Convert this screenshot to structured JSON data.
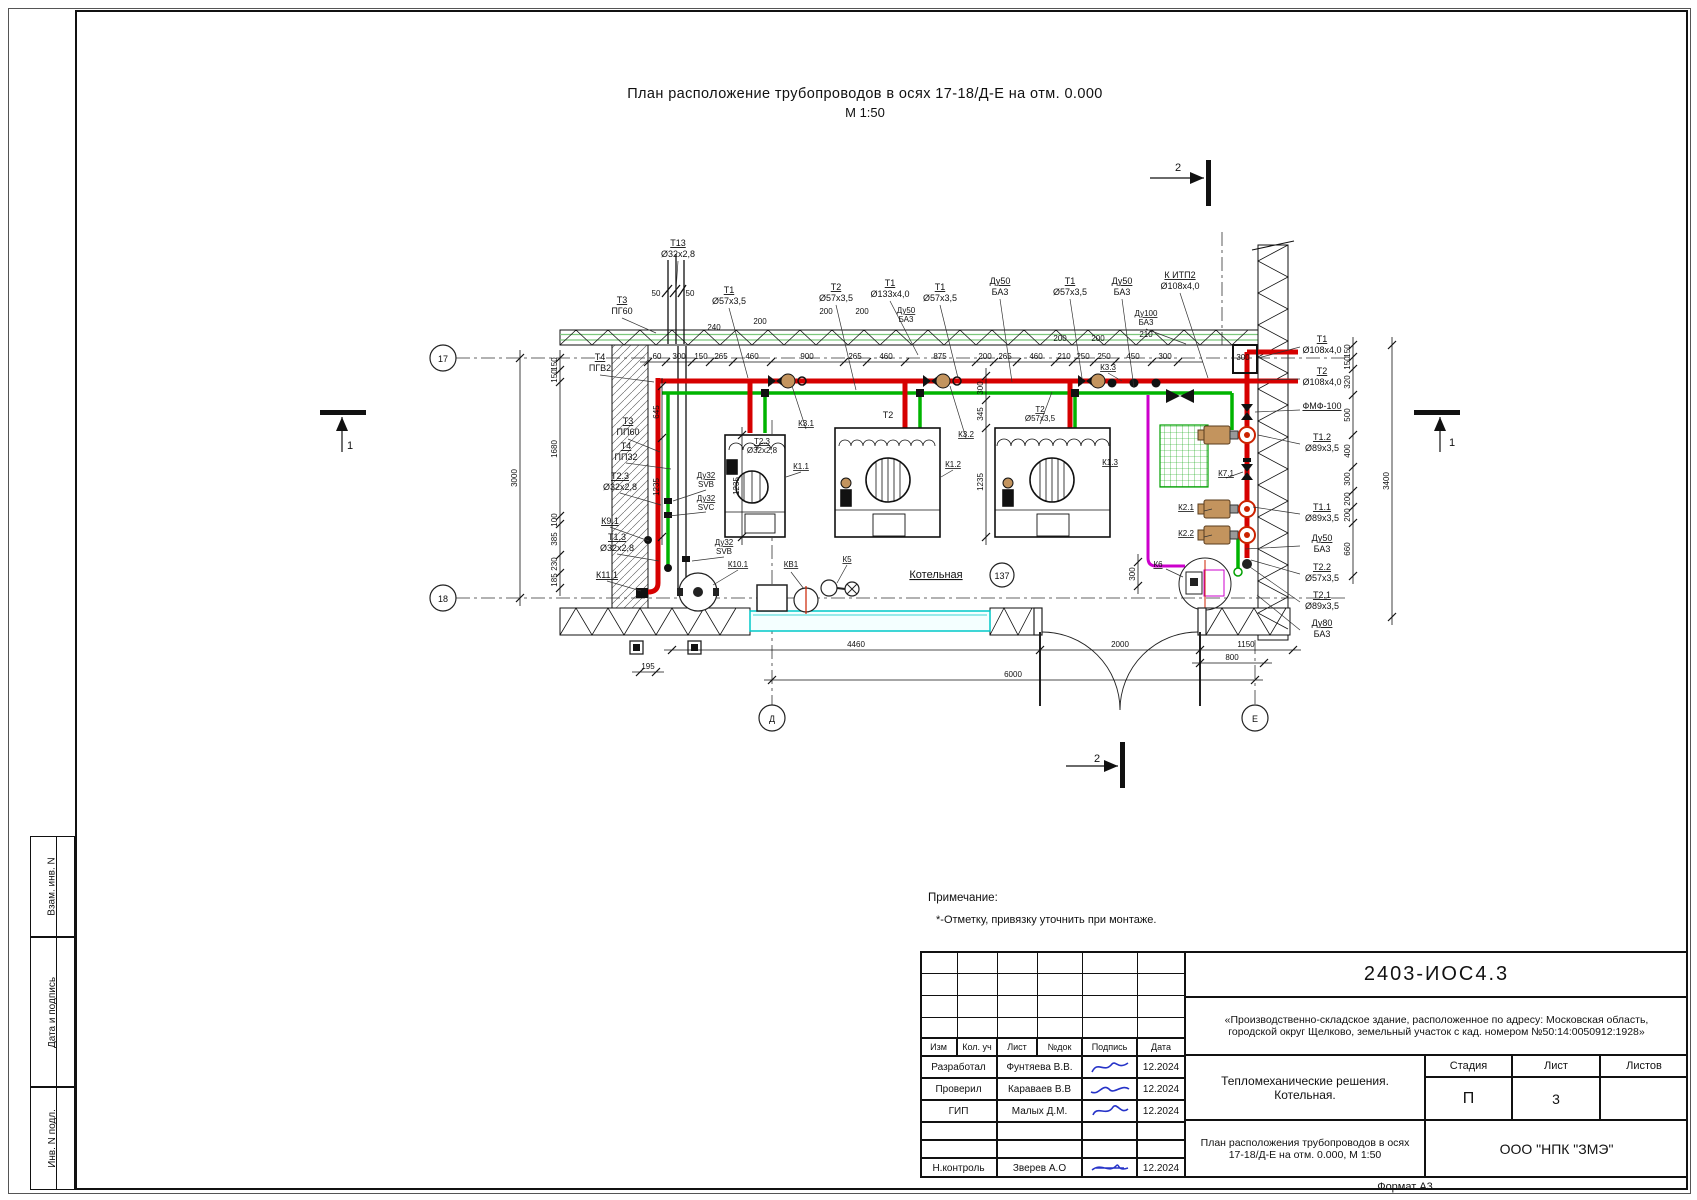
{
  "page": {
    "title_line1": "План расположение трубопроводов в осях 17-18/Д-Е на отм. 0.000",
    "title_line2": "М 1:50",
    "format_label": "Формат А3"
  },
  "sidebar": {
    "cells": [
      "Взам. инв. N",
      "Дата и подпись",
      "Инв. N подл."
    ]
  },
  "notes": {
    "heading": "Примечание:",
    "item1": "*-Отметку, привязку уточнить при монтаже."
  },
  "title_block": {
    "doc_number": "2403-ИОС4.3",
    "project_description": "«Производственно-складское здание, расположенное по адресу: Московская область, городской округ Щелково, земельный участок с кад. номером №50:14:0050912:1928»",
    "rev_headers": [
      "Изм",
      "Кол. уч",
      "Лист",
      "№док",
      "Подпись",
      "Дата"
    ],
    "signature_rows": [
      {
        "role": "Разработал",
        "name": "Фунтяева В.В.",
        "date": "12.2024"
      },
      {
        "role": "Проверил",
        "name": "Караваев В.В",
        "date": "12.2024"
      },
      {
        "role": "ГИП",
        "name": "Малых Д.М.",
        "date": "12.2024"
      },
      {
        "role": "Н.контроль",
        "name": "Зверев А.О",
        "date": "12.2024"
      }
    ],
    "section_title": "Тепломеханические решения. Котельная.",
    "sheet_title": "План расположения трубопроводов в осях 17-18/Д-Е на отм. 0.000, М 1:50",
    "stage_header": "Стадия",
    "sheet_header": "Лист",
    "sheets_header": "Листов",
    "stage_value": "П",
    "sheet_value": "3",
    "sheets_value": "",
    "company": "ООО \"НПК \"ЗМЭ\""
  },
  "plan": {
    "room_label": "Котельная",
    "room_number": "137",
    "colors": {
      "pipe_supply": "#d60000",
      "pipe_return": "#00b400",
      "pipe_aux": "#cc00cc",
      "channel": "#00c8c8",
      "pump_body": "#c3945e",
      "grate": "#00a000",
      "signature": "#2633c8"
    },
    "labels": [
      {
        "x": 678,
        "y": 246,
        "t": "Т13",
        "u": 1
      },
      {
        "x": 678,
        "y": 257,
        "t": "Ø32х2,8"
      },
      {
        "x": 656,
        "y": 296,
        "t": "50",
        "fs": 8
      },
      {
        "x": 690,
        "y": 296,
        "t": "50",
        "fs": 8
      },
      {
        "x": 622,
        "y": 303,
        "t": "Т3",
        "u": 1
      },
      {
        "x": 622,
        "y": 314,
        "t": "ПГ60"
      },
      {
        "x": 729,
        "y": 293,
        "t": "Т1",
        "u": 1
      },
      {
        "x": 729,
        "y": 304,
        "t": "Ø57х3,5"
      },
      {
        "x": 836,
        "y": 290,
        "t": "Т2",
        "u": 1
      },
      {
        "x": 836,
        "y": 301,
        "t": "Ø57х3,5"
      },
      {
        "x": 890,
        "y": 286,
        "t": "Т1",
        "u": 1
      },
      {
        "x": 890,
        "y": 297,
        "t": "Ø133х4,0"
      },
      {
        "x": 940,
        "y": 290,
        "t": "Т1",
        "u": 1
      },
      {
        "x": 940,
        "y": 301,
        "t": "Ø57х3,5"
      },
      {
        "x": 1000,
        "y": 284,
        "t": "Ду50",
        "u": 1
      },
      {
        "x": 1000,
        "y": 295,
        "t": "БА3"
      },
      {
        "x": 1070,
        "y": 284,
        "t": "Т1",
        "u": 1
      },
      {
        "x": 1070,
        "y": 295,
        "t": "Ø57х3,5"
      },
      {
        "x": 1122,
        "y": 284,
        "t": "Ду50",
        "u": 1
      },
      {
        "x": 1122,
        "y": 295,
        "t": "БА3"
      },
      {
        "x": 1180,
        "y": 278,
        "t": "К ИТП2",
        "u": 1
      },
      {
        "x": 1180,
        "y": 289,
        "t": "Ø108х4,0"
      },
      {
        "x": 1146,
        "y": 316,
        "t": "Ду100",
        "fs": 8,
        "u": 1
      },
      {
        "x": 1146,
        "y": 325,
        "t": "БА3",
        "fs": 8
      },
      {
        "x": 906,
        "y": 313,
        "t": "Ду50",
        "fs": 8,
        "u": 1
      },
      {
        "x": 906,
        "y": 322,
        "t": "БА3",
        "fs": 8
      },
      {
        "x": 714,
        "y": 330,
        "t": "240",
        "fs": 8
      },
      {
        "x": 760,
        "y": 324,
        "t": "200",
        "fs": 8
      },
      {
        "x": 826,
        "y": 314,
        "t": "200",
        "fs": 8
      },
      {
        "x": 862,
        "y": 314,
        "t": "200",
        "fs": 8
      },
      {
        "x": 1060,
        "y": 341,
        "t": "200",
        "fs": 8
      },
      {
        "x": 1098,
        "y": 341,
        "t": "200",
        "fs": 8
      },
      {
        "x": 1146,
        "y": 337,
        "t": "210",
        "fs": 8
      },
      {
        "x": 1108,
        "y": 370,
        "t": "К3.3",
        "fs": 8,
        "u": 1
      },
      {
        "x": 1243,
        "y": 360,
        "t": "300",
        "fs": 8
      },
      {
        "x": 1322,
        "y": 342,
        "t": "Т1",
        "u": 1
      },
      {
        "x": 1322,
        "y": 353,
        "t": "Ø108х4,0"
      },
      {
        "x": 1322,
        "y": 374,
        "t": "Т2",
        "u": 1
      },
      {
        "x": 1322,
        "y": 385,
        "t": "Ø108х4,0"
      },
      {
        "x": 1322,
        "y": 409,
        "t": "ФМФ-100",
        "u": 1
      },
      {
        "x": 1322,
        "y": 440,
        "t": "Т1.2",
        "u": 1
      },
      {
        "x": 1322,
        "y": 451,
        "t": "Ø89х3,5"
      },
      {
        "x": 1322,
        "y": 510,
        "t": "Т1.1",
        "u": 1
      },
      {
        "x": 1322,
        "y": 521,
        "t": "Ø89х3,5"
      },
      {
        "x": 1322,
        "y": 541,
        "t": "Ду50",
        "u": 1
      },
      {
        "x": 1322,
        "y": 552,
        "t": "БА3"
      },
      {
        "x": 1322,
        "y": 570,
        "t": "Т2.2",
        "u": 1
      },
      {
        "x": 1322,
        "y": 581,
        "t": "Ø57х3,5"
      },
      {
        "x": 1322,
        "y": 598,
        "t": "Т2.1",
        "u": 1
      },
      {
        "x": 1322,
        "y": 609,
        "t": "Ø89х3,5"
      },
      {
        "x": 1322,
        "y": 626,
        "t": "Ду80",
        "u": 1
      },
      {
        "x": 1322,
        "y": 637,
        "t": "БА3"
      },
      {
        "x": 600,
        "y": 360,
        "t": "Т4",
        "u": 1
      },
      {
        "x": 600,
        "y": 371,
        "t": "ПГВ2"
      },
      {
        "x": 628,
        "y": 424,
        "t": "Т3",
        "u": 1
      },
      {
        "x": 628,
        "y": 435,
        "t": "ПП60"
      },
      {
        "x": 626,
        "y": 449,
        "t": "Т4",
        "u": 1
      },
      {
        "x": 626,
        "y": 460,
        "t": "ПП32"
      },
      {
        "x": 620,
        "y": 479,
        "t": "Т2.3",
        "u": 1
      },
      {
        "x": 620,
        "y": 490,
        "t": "Ø32х2,8"
      },
      {
        "x": 610,
        "y": 524,
        "t": "К9.1",
        "u": 1
      },
      {
        "x": 617,
        "y": 540,
        "t": "Т1.3",
        "u": 1
      },
      {
        "x": 617,
        "y": 551,
        "t": "Ø32х2,8"
      },
      {
        "x": 607,
        "y": 578,
        "t": "К11.1",
        "u": 1
      },
      {
        "x": 706,
        "y": 478,
        "t": "Ду32",
        "fs": 8,
        "u": 1
      },
      {
        "x": 706,
        "y": 487,
        "t": "SVB",
        "fs": 8
      },
      {
        "x": 706,
        "y": 501,
        "t": "Ду32",
        "fs": 8,
        "u": 1
      },
      {
        "x": 706,
        "y": 510,
        "t": "SVC",
        "fs": 8
      },
      {
        "x": 724,
        "y": 545,
        "t": "Ду32",
        "fs": 8,
        "u": 1
      },
      {
        "x": 724,
        "y": 554,
        "t": "SVB",
        "fs": 8
      },
      {
        "x": 738,
        "y": 567,
        "t": "К10.1",
        "fs": 8,
        "u": 1
      },
      {
        "x": 791,
        "y": 567,
        "t": "КВ1",
        "fs": 8,
        "u": 1
      },
      {
        "x": 847,
        "y": 562,
        "t": "К5",
        "fs": 8,
        "u": 1
      },
      {
        "x": 762,
        "y": 444,
        "t": "Т2.3",
        "fs": 8,
        "u": 1
      },
      {
        "x": 762,
        "y": 453,
        "t": "Ø32х2,8",
        "fs": 8
      },
      {
        "x": 801,
        "y": 469,
        "t": "К1.1",
        "fs": 8,
        "u": 1
      },
      {
        "x": 806,
        "y": 426,
        "t": "К3.1",
        "fs": 8,
        "u": 1
      },
      {
        "x": 888,
        "y": 418,
        "t": "Т2",
        "fs": 9
      },
      {
        "x": 953,
        "y": 467,
        "t": "К1.2",
        "fs": 8,
        "u": 1
      },
      {
        "x": 966,
        "y": 437,
        "t": "К3.2",
        "fs": 8,
        "u": 1
      },
      {
        "x": 1040,
        "y": 412,
        "t": "Т2",
        "fs": 8,
        "u": 1
      },
      {
        "x": 1040,
        "y": 421,
        "t": "Ø57х3,5",
        "fs": 8
      },
      {
        "x": 1110,
        "y": 465,
        "t": "К1.3",
        "fs": 8,
        "u": 1
      },
      {
        "x": 936,
        "y": 578,
        "t": "Котельная",
        "fs": 11,
        "u": 1
      },
      {
        "x": 1002,
        "y": 579,
        "t": "137",
        "fs": 9
      },
      {
        "x": 1226,
        "y": 476,
        "t": "К7.1",
        "fs": 8,
        "u": 1
      },
      {
        "x": 1186,
        "y": 510,
        "t": "К2.1",
        "fs": 8,
        "u": 1
      },
      {
        "x": 1186,
        "y": 536,
        "t": "К2.2",
        "fs": 8,
        "u": 1
      },
      {
        "x": 1158,
        "y": 567,
        "t": "К6",
        "fs": 8,
        "u": 1
      },
      {
        "x": 443,
        "y": 362,
        "t": "17",
        "fs": 9
      },
      {
        "x": 443,
        "y": 602,
        "t": "18",
        "fs": 9
      },
      {
        "x": 772,
        "y": 722,
        "t": "Д",
        "fs": 9
      },
      {
        "x": 1255,
        "y": 722,
        "t": "Е",
        "fs": 9
      },
      {
        "x": 1178,
        "y": 171,
        "t": "2",
        "fs": 11
      },
      {
        "x": 1097,
        "y": 762,
        "t": "2",
        "fs": 11
      },
      {
        "x": 350,
        "y": 449,
        "t": "1",
        "fs": 11
      },
      {
        "x": 1452,
        "y": 446,
        "t": "1",
        "fs": 11
      }
    ],
    "dim_chains": [
      {
        "o": "h",
        "p": 362,
        "a": 648,
        "b": 1195,
        "ticks": [
          648,
          666,
          692,
          710,
          733,
          771,
          844,
          867,
          905,
          976,
          994,
          1017,
          1055,
          1073,
          1094,
          1115,
          1152,
          1178
        ],
        "vals": [
          [
            657,
            "60"
          ],
          [
            679,
            "300"
          ],
          [
            701,
            "150"
          ],
          [
            721,
            "265"
          ],
          [
            752,
            "460"
          ],
          [
            807,
            "900"
          ],
          [
            855,
            "265"
          ],
          [
            886,
            "460"
          ],
          [
            940,
            "875"
          ],
          [
            985,
            "200"
          ],
          [
            1005,
            "265"
          ],
          [
            1036,
            "460"
          ],
          [
            1064,
            "210"
          ],
          [
            1083,
            "250"
          ],
          [
            1104,
            "250"
          ],
          [
            1133,
            "450"
          ],
          [
            1165,
            "300"
          ]
        ]
      },
      {
        "o": "v",
        "p": 520,
        "a": 358,
        "b": 598,
        "ticks": [
          358,
          598
        ],
        "vals": [
          [
            478,
            "3000"
          ]
        ]
      },
      {
        "o": "v",
        "p": 560,
        "a": 358,
        "b": 588,
        "ticks": [
          358,
          370,
          382,
          516,
          524,
          555,
          573,
          588
        ],
        "vals": [
          [
            364,
            "150"
          ],
          [
            376,
            "150"
          ],
          [
            449,
            "1680"
          ],
          [
            520,
            "100"
          ],
          [
            539,
            "385"
          ],
          [
            564,
            "230"
          ],
          [
            580,
            "185"
          ]
        ]
      },
      {
        "o": "v",
        "p": 662,
        "a": 386,
        "b": 537,
        "ticks": [
          386,
          438,
          537
        ],
        "vals": [
          [
            412,
            "645"
          ],
          [
            487,
            "1235"
          ]
        ]
      },
      {
        "o": "v",
        "p": 742,
        "a": 435,
        "b": 537,
        "ticks": [
          435,
          537
        ],
        "vals": [
          [
            486,
            "1235"
          ]
        ]
      },
      {
        "o": "v",
        "p": 986,
        "a": 376,
        "b": 537,
        "ticks": [
          376,
          400,
          428,
          537
        ],
        "vals": [
          [
            388,
            "300"
          ],
          [
            414,
            "345"
          ],
          [
            482,
            "1235"
          ]
        ]
      },
      {
        "o": "v",
        "p": 1353,
        "a": 345,
        "b": 576,
        "ticks": [
          345,
          357,
          369,
          395,
          435,
          467,
          491,
          507,
          523,
          576
        ],
        "vals": [
          [
            351,
            "150"
          ],
          [
            363,
            "150"
          ],
          [
            382,
            "320"
          ],
          [
            415,
            "500"
          ],
          [
            451,
            "400"
          ],
          [
            479,
            "300"
          ],
          [
            499,
            "200"
          ],
          [
            515,
            "200"
          ],
          [
            549,
            "660"
          ]
        ]
      },
      {
        "o": "v",
        "p": 1392,
        "a": 345,
        "b": 617,
        "ticks": [
          345,
          617
        ],
        "vals": [
          [
            481,
            "3400"
          ]
        ]
      },
      {
        "o": "v",
        "p": 1138,
        "a": 562,
        "b": 586,
        "ticks": [
          562,
          586
        ],
        "vals": [
          [
            574,
            "300"
          ]
        ]
      },
      {
        "o": "h",
        "p": 650,
        "a": 672,
        "b": 1293,
        "ticks": [
          672,
          1040,
          1200,
          1293
        ],
        "vals": [
          [
            856,
            "4460"
          ],
          [
            1120,
            "2000"
          ],
          [
            1246,
            "1150"
          ]
        ]
      },
      {
        "o": "h",
        "p": 680,
        "a": 772,
        "b": 1255,
        "ticks": [
          772,
          1255
        ],
        "vals": [
          [
            1013,
            "6000"
          ]
        ]
      },
      {
        "o": "h",
        "p": 663,
        "a": 1200,
        "b": 1264,
        "ticks": [
          1200,
          1264
        ],
        "vals": [
          [
            1232,
            "800"
          ]
        ]
      },
      {
        "o": "h",
        "p": 672,
        "a": 640,
        "b": 656,
        "ticks": [
          640,
          656
        ],
        "vals": [
          [
            648,
            "195"
          ]
        ]
      }
    ]
  }
}
